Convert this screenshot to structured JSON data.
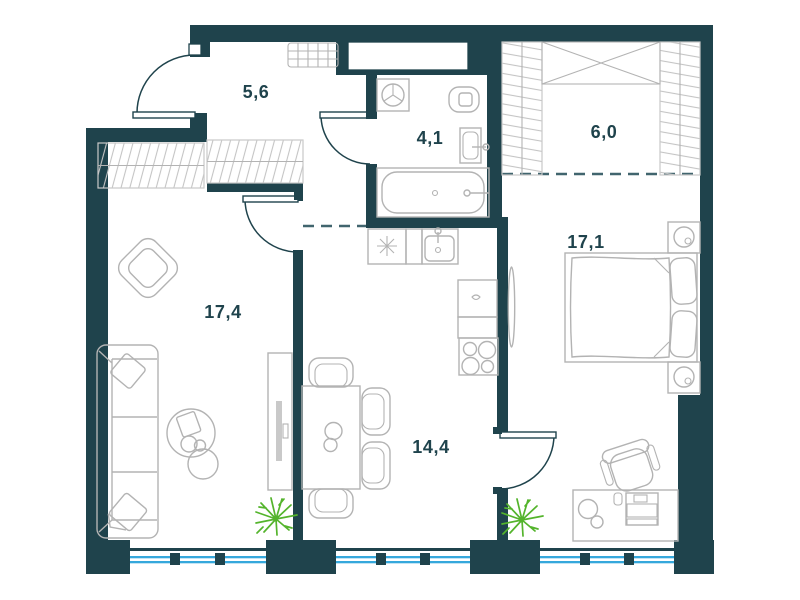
{
  "title": "Apartment floor plan",
  "rooms": [
    {
      "id": "hallway",
      "area_label": "5,6"
    },
    {
      "id": "bathroom",
      "area_label": "4,1"
    },
    {
      "id": "wardrobe",
      "area_label": "6,0"
    },
    {
      "id": "bedroom",
      "area_label": "17,1"
    },
    {
      "id": "living-room",
      "area_label": "17,4"
    },
    {
      "id": "kitchen-dining",
      "area_label": "14,4"
    }
  ],
  "colors": {
    "wall": "#1f434c",
    "furniture": "#b3b3b3",
    "hatch": "#c4c4c4",
    "window": "#35a8dc",
    "plant": "#54b42c",
    "label": "#1f434c",
    "dash": "#41656e",
    "background": "#ffffff"
  },
  "symbols": [
    "entrance-door",
    "living-room-door",
    "bathroom-door",
    "bedroom-door",
    "sofa",
    "throw-pillow",
    "armchair",
    "coffee-table",
    "tv-console",
    "plant",
    "dining-table",
    "dining-chair",
    "plate",
    "kitchen-counter",
    "kitchen-sink",
    "stove",
    "washing-machine",
    "toilet",
    "bathroom-sink",
    "bathtub",
    "shoe-rack",
    "wardrobe-rail",
    "wardrobe-cabinet",
    "bed",
    "bed-pillow",
    "nightstand",
    "lamp",
    "standing-mirror",
    "desk",
    "office-chair",
    "window"
  ]
}
